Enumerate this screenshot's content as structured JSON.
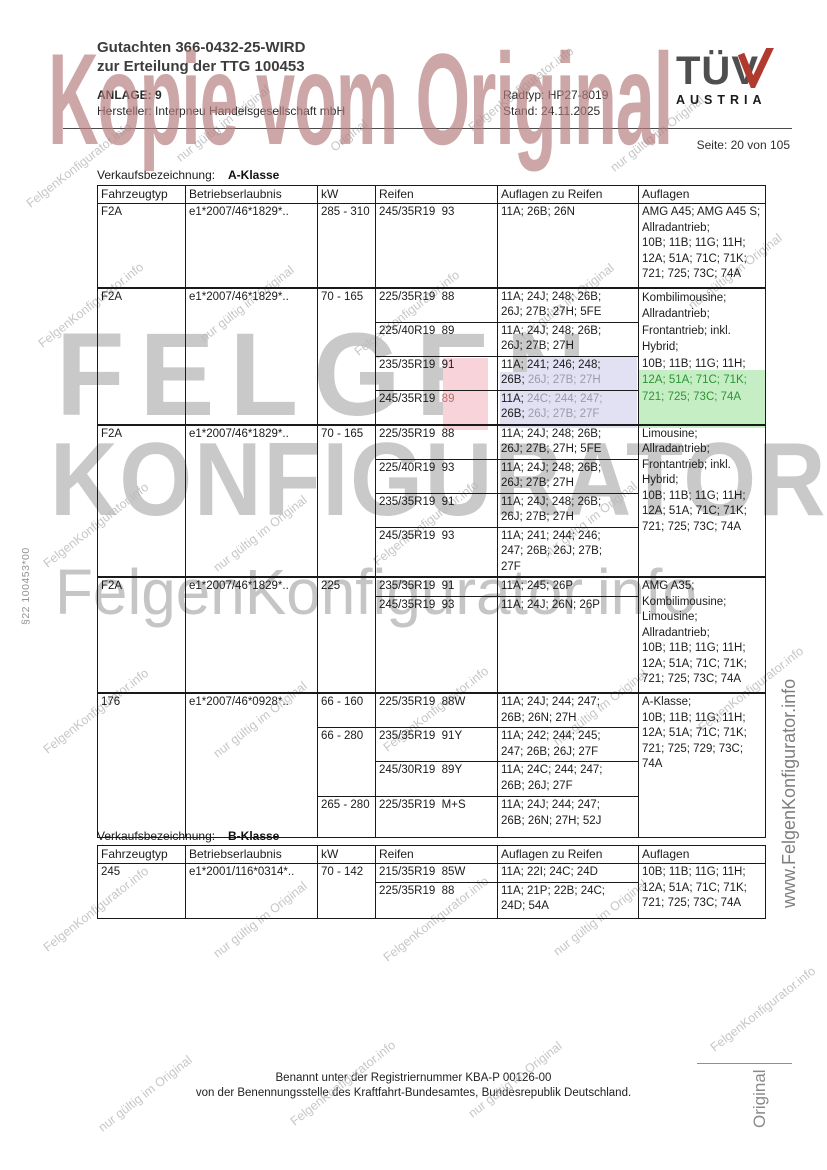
{
  "header": {
    "gutachten_line1": "Gutachten 366-0432-25-WIRD",
    "gutachten_line2": "zur Erteilung der TTG 100453",
    "anlage": "ANLAGE: 9",
    "hersteller": "Hersteller: Interpneu Handelsgesellschaft mbH",
    "radtyp": "Radtyp: HP27-8019",
    "stand": "Stand: 24.11.2025",
    "seite": "Seite: 20 von 105",
    "logo_tuv": "TÜV",
    "logo_austria": "AUSTRIA"
  },
  "watermarks": {
    "kopie": "Kopie vom Original",
    "felgen": "FELGEN",
    "konfigurator": "KONFIGURATOR",
    "fk_info": "FelgenKonfigurator.info",
    "nur_gueltig": "nur gültig im Original",
    "original": "Original",
    "www": "www.FelgenKonfigurator.info",
    "paragraph": "§22  100453*00"
  },
  "table_a": {
    "caption_label": "Verkaufsbezeichnung:",
    "caption_value": "A-Klasse",
    "headers": [
      "Fahrzeugtyp",
      "Betriebserlaubnis",
      "kW",
      "Reifen",
      "Auflagen zu Reifen",
      "Auflagen"
    ],
    "groups": [
      {
        "typ": "F2A",
        "be": "e1*2007/46*1829*..",
        "kw": "285 - 310",
        "rows": [
          {
            "tire": "245/35R19  93",
            "cond": "11A; 26B; 26N"
          }
        ],
        "auflagen": "AMG A45; AMG A45 S;\nAllradantrieb;\n10B; 11B; 11G; 11H;\n12A; 51A; 71C; 71K;\n721; 725; 73C; 74A"
      },
      {
        "typ": "F2A",
        "be": "e1*2007/46*1829*..",
        "kw": "70 - 165",
        "rows": [
          {
            "tire": "225/35R19  88",
            "cond": "11A; 24J; 248; 26B;\n26J; 27B; 27H; 5FE"
          },
          {
            "tire": "225/40R19  89",
            "cond": "11A; 24J; 248; 26B;\n26J; 27B; 27H"
          },
          {
            "tire": "235/35R19  91",
            "c1": "11A; 241; 246; 248;\n26B; ",
            "c2": "26J; 27B; 27H"
          },
          {
            "tire_base": "245/35R19  ",
            "tire_red": "89",
            "s1": "11A; ",
            "s2": "24C; 244; 247;\n",
            "s3": "26B; ",
            "s4": "26J; 27B; 27F"
          }
        ],
        "auflagen_black": "Kombilimousine;\nAllradantrieb;\nFrontantrieb; inkl.\nHybrid;\n10B; 11B; 11G; 11H;",
        "auflagen_green": "12A; 51A; 71C; 71K;\n721; 725; 73C; 74A"
      },
      {
        "typ": "F2A",
        "be": "e1*2007/46*1829*..",
        "kw": "70 - 165",
        "rows": [
          {
            "tire": "225/35R19  88",
            "cond": "11A; 24J; 248; 26B;\n26J; 27B; 27H; 5FE"
          },
          {
            "tire": "225/40R19  93",
            "cond": "11A; 24J; 248; 26B;\n26J; 27B; 27H"
          },
          {
            "tire": "235/35R19  91",
            "cond": "11A; 24J; 248; 26B;\n26J; 27B; 27H"
          },
          {
            "tire": "245/35R19  93",
            "cond": "11A; 241; 244; 246;\n247; 26B; 26J; 27B;\n27F"
          }
        ],
        "auflagen": "Limousine;\nAllradantrieb;\nFrontantrieb; inkl.\nHybrid;\n10B; 11B; 11G; 11H;\n12A; 51A; 71C; 71K;\n721; 725; 73C; 74A"
      },
      {
        "typ": "F2A",
        "be": "e1*2007/46*1829*..",
        "kw": "225",
        "rows": [
          {
            "tire": "235/35R19  91",
            "cond": "11A; 245; 26P"
          },
          {
            "tire": "245/35R19  93",
            "cond": "11A; 24J; 26N; 26P"
          }
        ],
        "auflagen": "AMG A35;\nKombilimousine;\nLimousine;\nAllradantrieb;\n10B; 11B; 11G; 11H;\n12A; 51A; 71C; 71K;\n721; 725; 73C; 74A"
      },
      {
        "typ": "176",
        "be": "e1*2007/46*0928*..",
        "kw1": "66 - 160",
        "kw2": "66 - 280",
        "kw3": "265 - 280",
        "rows": [
          {
            "tire": "225/35R19  88W",
            "cond": "11A; 24J; 244; 247;\n26B; 26N; 27H"
          },
          {
            "tire": "235/35R19  91Y",
            "cond": "11A; 242; 244; 245;\n247; 26B; 26J; 27F"
          },
          {
            "tire": "245/30R19  89Y",
            "cond": "11A; 24C; 244; 247;\n26B; 26J; 27F"
          },
          {
            "tire": "225/35R19  M+S",
            "cond": "11A; 24J; 244; 247;\n26B; 26N; 27H; 52J"
          }
        ],
        "auflagen": "A-Klasse;\n10B; 11B; 11G; 11H;\n12A; 51A; 71C; 71K;\n721; 725; 729; 73C;\n74A"
      }
    ]
  },
  "table_b": {
    "caption_label": "Verkaufsbezeichnung:",
    "caption_value": "B-Klasse",
    "headers": [
      "Fahrzeugtyp",
      "Betriebserlaubnis",
      "kW",
      "Reifen",
      "Auflagen zu Reifen",
      "Auflagen"
    ],
    "group": {
      "typ": "245",
      "be": "e1*2001/116*0314*..",
      "kw": "70 - 142",
      "rows": [
        {
          "tire": "215/35R19  85W",
          "cond": "11A; 22I; 24C; 24D"
        },
        {
          "tire": "225/35R19  88",
          "cond": "11A; 21P; 22B; 24C;\n24D; 54A"
        }
      ],
      "auflagen": "10B; 11B; 11G; 11H;\n12A; 51A; 71C; 71K;\n721; 725; 73C; 74A"
    }
  },
  "footer": {
    "line1": "Benannt unter der Registriernummer KBA-P 00126-00",
    "line2": "von der Benennungsstelle des Kraftfahrt-Bundesamtes, Bundesrepublik Deutschland."
  }
}
